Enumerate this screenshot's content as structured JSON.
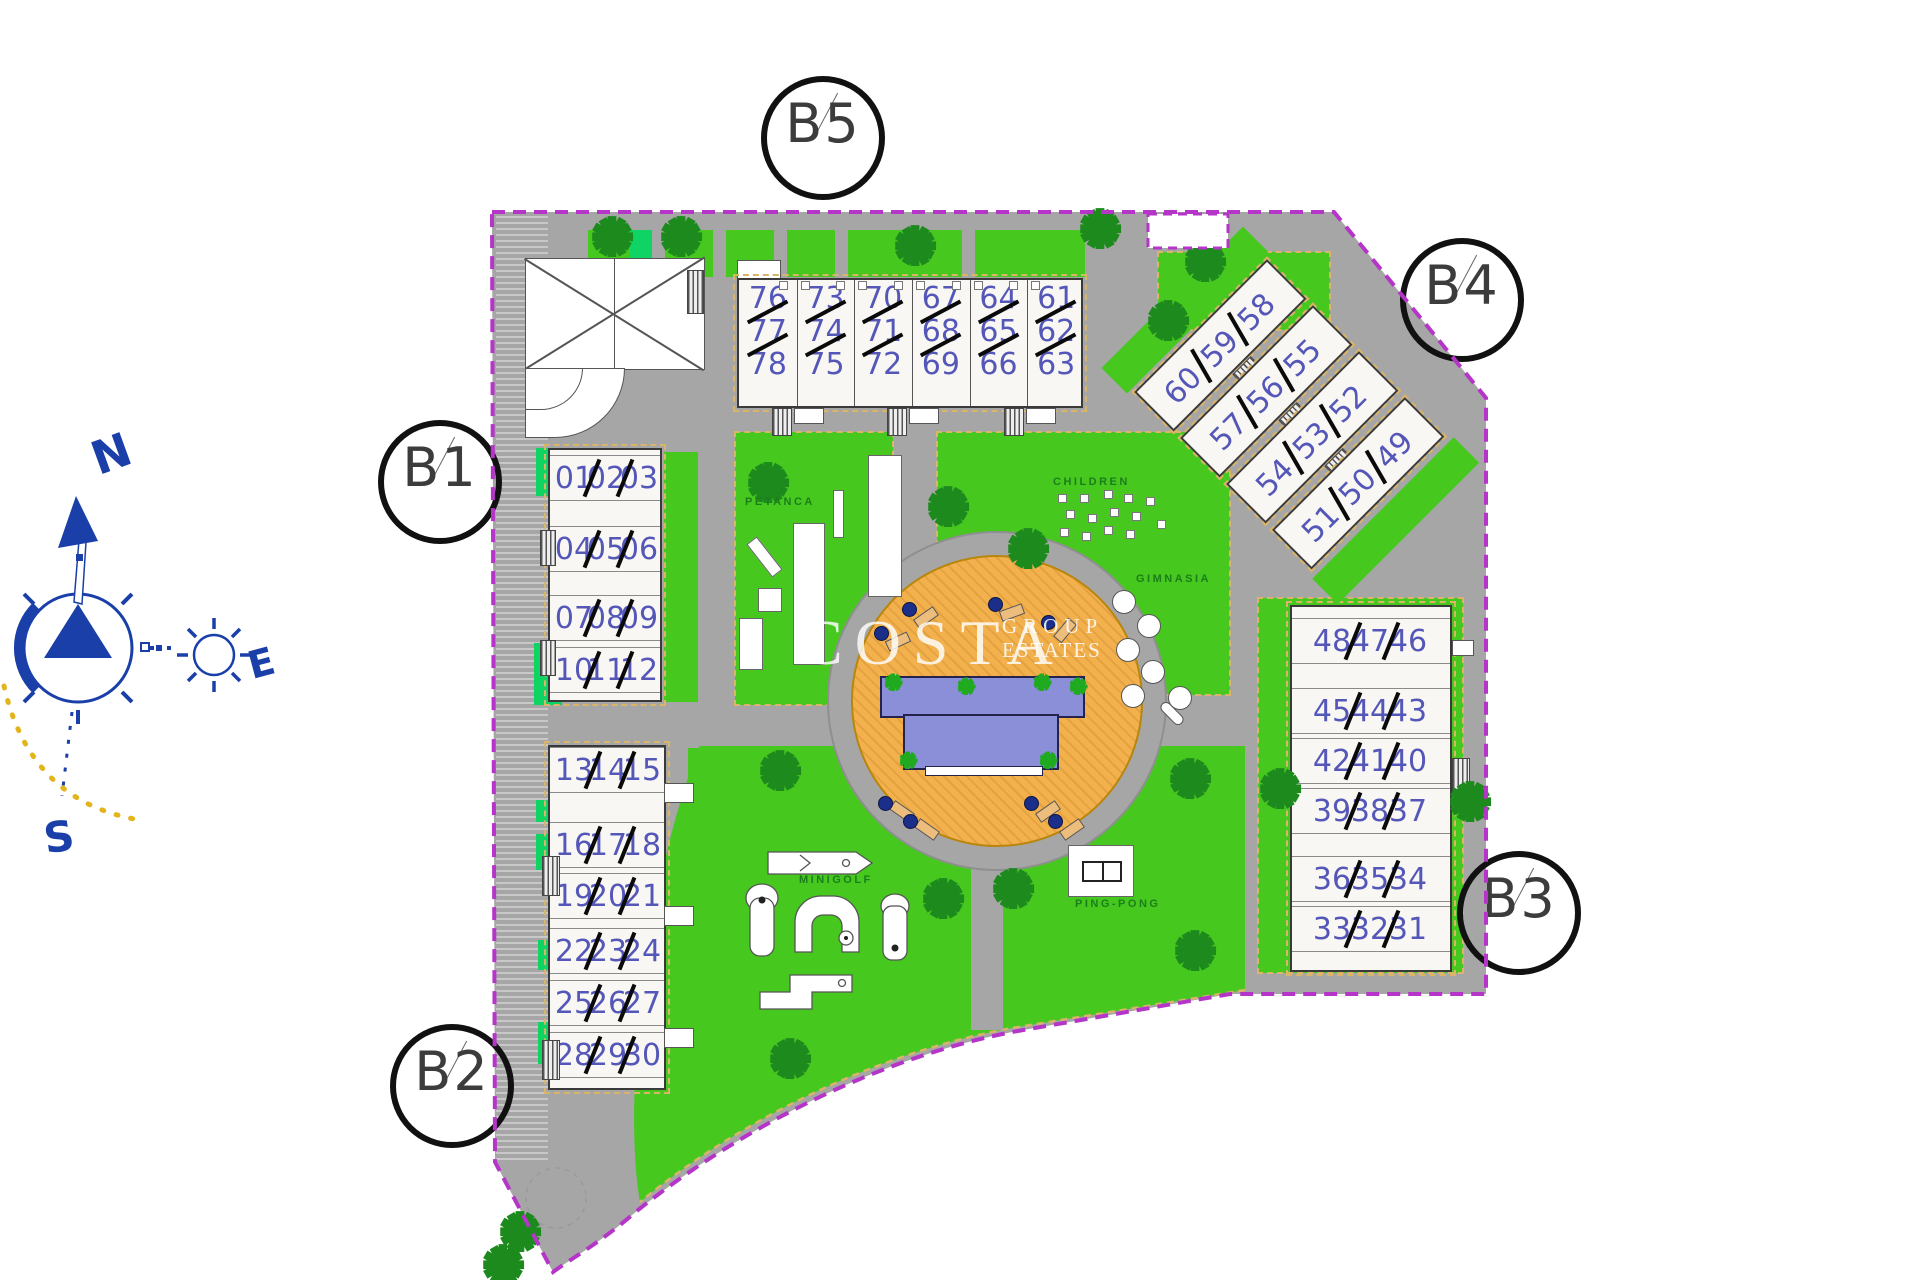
{
  "plan": {
    "blocks": {
      "b1": {
        "label": "B1",
        "rows": [
          [
            "01",
            "02",
            "03"
          ],
          [
            "04",
            "05",
            "06"
          ],
          [
            "07",
            "08",
            "09"
          ],
          [
            "10",
            "11",
            "12"
          ]
        ]
      },
      "b2": {
        "label": "B2",
        "rows": [
          [
            "13",
            "14",
            "15"
          ],
          [
            "16",
            "17",
            "18"
          ],
          [
            "19",
            "20",
            "21"
          ],
          [
            "22",
            "23",
            "24"
          ],
          [
            "25",
            "26",
            "27"
          ],
          [
            "28",
            "29",
            "30"
          ]
        ]
      },
      "b3": {
        "label": "B3",
        "rows": [
          [
            "48",
            "47",
            "46"
          ],
          [
            "45",
            "44",
            "43"
          ],
          [
            "42",
            "41",
            "40"
          ],
          [
            "39",
            "38",
            "37"
          ],
          [
            "36",
            "35",
            "34"
          ],
          [
            "33",
            "32",
            "31"
          ]
        ]
      },
      "b4": {
        "label": "B4",
        "rows": [
          [
            "60",
            "59",
            "58"
          ],
          [
            "57",
            "56",
            "55"
          ],
          [
            "54",
            "53",
            "52"
          ],
          [
            "51",
            "50",
            "49"
          ]
        ]
      },
      "b5": {
        "label": "B5",
        "columns": [
          [
            "76",
            "77",
            "78"
          ],
          [
            "73",
            "74",
            "75"
          ],
          [
            "70",
            "71",
            "72"
          ],
          [
            "67",
            "68",
            "69"
          ],
          [
            "64",
            "65",
            "66"
          ],
          [
            "61",
            "62",
            "63"
          ]
        ]
      }
    },
    "amenities": {
      "petanca": "PETANCA",
      "children": "CHILDREN",
      "gimnasia": "GIMNASIA",
      "minigolf": "MINIGOLF",
      "ping_pong": "PING-PONG"
    },
    "compass": {
      "north": "N",
      "east": "E",
      "south": "S"
    },
    "watermark": {
      "brand": "COSTA",
      "word2": "GROUP",
      "word3": "ESTATES"
    },
    "icons": {
      "tree": "✱"
    },
    "colors": {
      "boundary": "#b535c8",
      "lawn": "#46c81f",
      "lawn_bright": "#0fd463",
      "road": "#a6a6a6",
      "deck": "#f3b14e",
      "pool": "#8a8fd8",
      "unit_number": "#5457b8",
      "tree": "#1d8a1d",
      "compass": "#1a3fa8",
      "sun_arc": "#e2b51c",
      "sand_edge": "#d9b469"
    }
  }
}
